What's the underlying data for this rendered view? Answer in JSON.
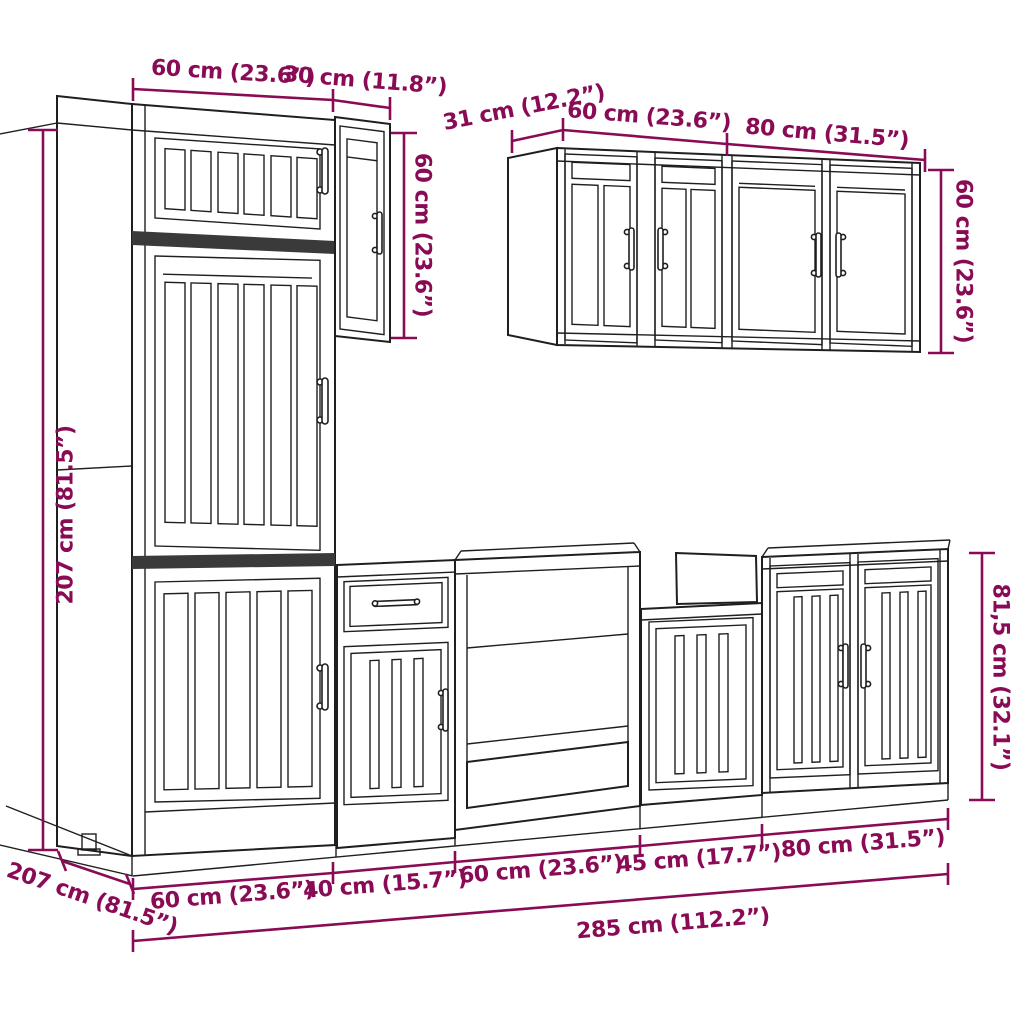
{
  "colors": {
    "background": "#ffffff",
    "line_art": "#1f1f1f",
    "band": "#3a3a3a",
    "dim": "#8a0b55"
  },
  "diagram": {
    "type": "product-dimension-diagram",
    "subject": "7-piece kitchen cabinet set line drawing with measurements"
  },
  "dimensions": {
    "tall_width": "60 cm (23.6”)",
    "wall_small_width": "30 cm (11.8”)",
    "left_height": "207 cm (81.5”)",
    "wall_small_height": "60 cm (23.6”)",
    "upper_depth": "31 cm (12.2”)",
    "upper_width_left": "60 cm (23.6”)",
    "upper_width_right": "80 cm (31.5”)",
    "upper_height": "60 cm (23.6”)",
    "base_height": "81,5 cm (32.1”)",
    "depth_total": "207 cm (81.5”)",
    "base_w1": "60 cm (23.6”)",
    "base_w2": "40 cm (15.7”)",
    "base_w3": "60 cm (23.6”)",
    "base_w4": "45 cm (17.7”)",
    "base_w5": "80 cm (31.5”)",
    "total_width": "285 cm (112.2”)"
  }
}
